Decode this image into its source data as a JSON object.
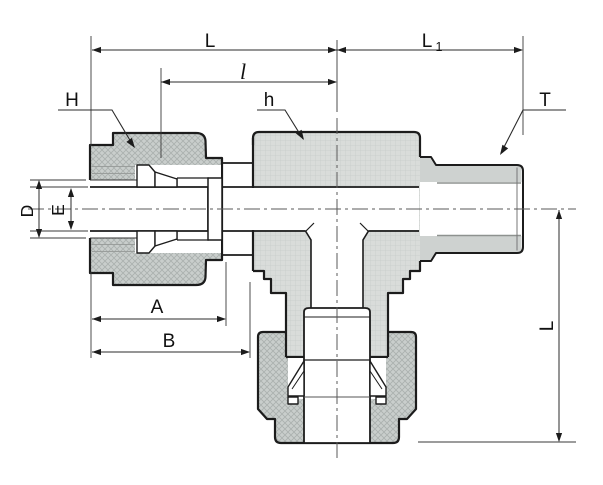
{
  "drawing": {
    "kind": "technical cross-section drawing of a male branch tee compression tube fitting",
    "dims": {
      "L_top": "L",
      "L1_base": "L",
      "L1_sub": "1",
      "l_offset": "l",
      "H_nut": "H",
      "h_body": "h",
      "T_thread": "T",
      "D_tube": "D",
      "E_bore": "E",
      "A_len": "A",
      "B_len": "B",
      "L_vertical": "L"
    },
    "colors": {
      "line": "#1c1c1c",
      "dim_line": "#2b2b2b",
      "gray_line": "#8e928f",
      "centerline": "#5a5a5a",
      "body_fill": "#d9dcda",
      "body_grid": "#c8ccca",
      "nut_fill": "#c9cecc",
      "nut_hatch": "#aab0ae",
      "thread_band": "#ced2d0",
      "background": "#ffffff"
    }
  }
}
